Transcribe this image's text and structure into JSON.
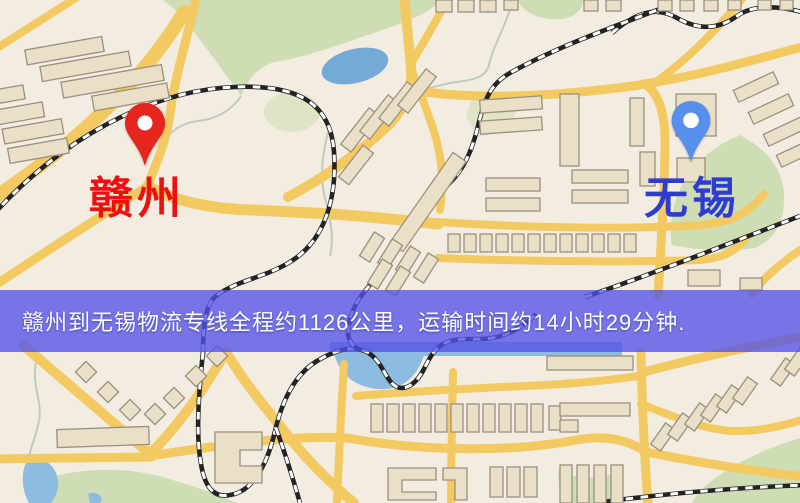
{
  "route_banner": {
    "text": "赣州到无锡物流专线全程约1126公里，运输时间约14小时29分钟."
  },
  "markers": [
    {
      "name": "origin",
      "label": "赣州",
      "pin_color": "#e6251e",
      "label_color": "#ee1010",
      "x": 145,
      "y": 168,
      "label_x": 137,
      "label_y": 177
    },
    {
      "name": "destination",
      "label": "无锡",
      "pin_color": "#568fec",
      "label_color": "#2e3cd2",
      "x": 690,
      "y": 166,
      "label_x": 692,
      "label_y": 177
    }
  ],
  "map": {
    "palette": {
      "background": "#f3ede1",
      "road": "#f2c964",
      "building_fill": "#eae0c8",
      "building_stroke": "#9b9080",
      "green_area": "#cfddb5",
      "water": "#8fbbdf",
      "lake": "#76a9d4",
      "railway": "#232323",
      "banner_overlay": "rgba(82,82,232,0.78)"
    }
  }
}
